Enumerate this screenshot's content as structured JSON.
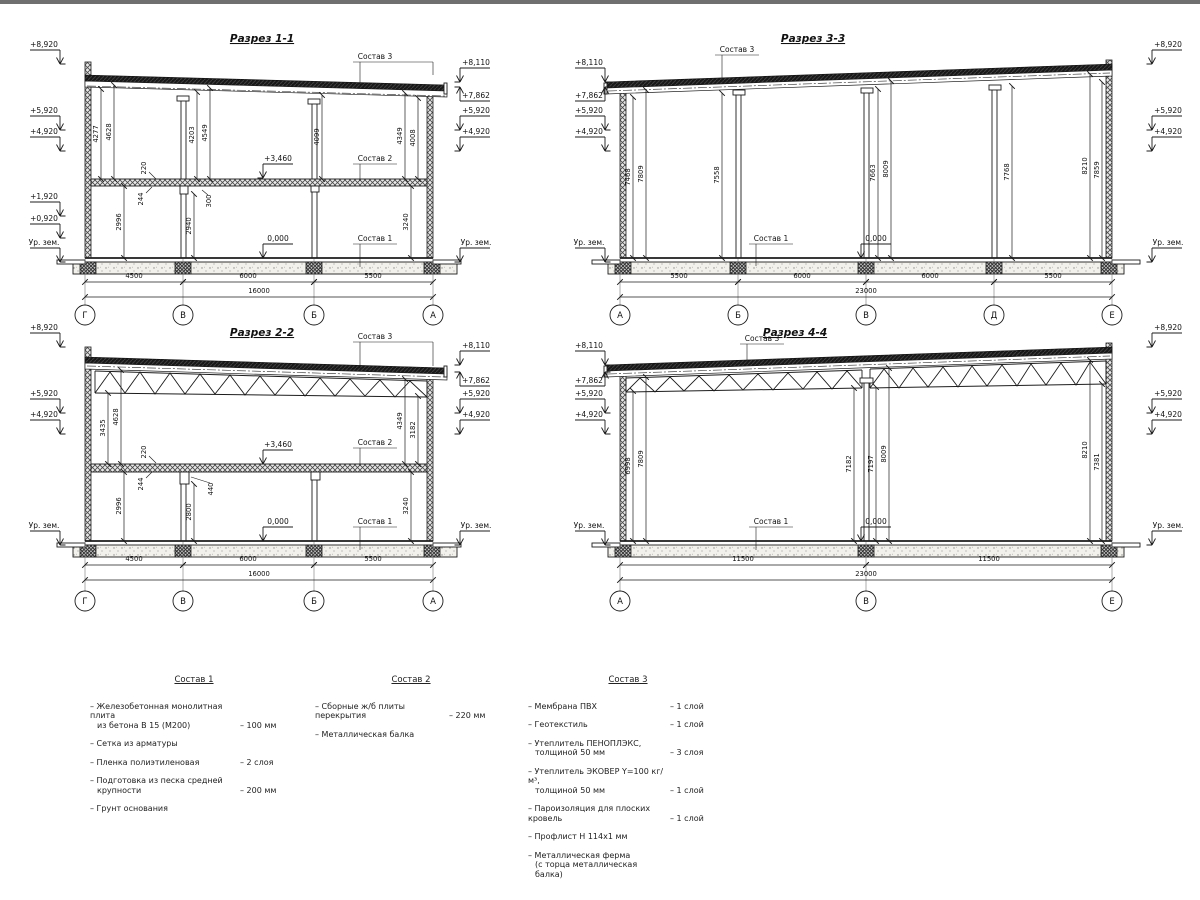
{
  "s11": {
    "title": "Разрез 1-1",
    "elev_left": [
      "+8,920",
      "+5,920",
      "+4,920",
      "+1,920",
      "+0,920",
      "Ур. зем."
    ],
    "elev_right": [
      "+8,110",
      "+7,862",
      "+5,920",
      "+4,920",
      "Ур. зем."
    ],
    "levels": [
      "+3,460",
      "0,000"
    ],
    "labels": [
      "Состав 3",
      "Состав 2",
      "Состав 1"
    ],
    "vdims": [
      "4277",
      "4628",
      "4203",
      "4549",
      "4099",
      "4349",
      "4008",
      "220",
      "244",
      "300",
      "2996",
      "2940",
      "3240"
    ],
    "bdims": [
      "4500",
      "6000",
      "5500"
    ],
    "total": "16000",
    "axes": [
      "Г",
      "В",
      "Б",
      "А"
    ]
  },
  "s22": {
    "title": "Разрез 2-2",
    "elev_left": [
      "+8,920",
      "+5,920",
      "+4,920",
      "Ур. зем."
    ],
    "elev_right": [
      "+8,110",
      "+7,862",
      "+5,920",
      "+4,920",
      "Ур. зем."
    ],
    "levels": [
      "+3,460",
      "0,000"
    ],
    "labels": [
      "Состав 3",
      "Состав 2",
      "Состав 1"
    ],
    "vdims": [
      "3435",
      "4628",
      "220",
      "244",
      "2996",
      "2800",
      "440",
      "4349",
      "3182",
      "3240"
    ],
    "bdims": [
      "4500",
      "6000",
      "5500"
    ],
    "total": "16000",
    "axes": [
      "Г",
      "В",
      "Б",
      "А"
    ]
  },
  "s33": {
    "title": "Разрез 3-3",
    "elev_left": [
      "+8,110",
      "+7,862",
      "+5,920",
      "+4,920",
      "Ур. зем."
    ],
    "elev_right": [
      "+8,920",
      "+5,920",
      "+4,920",
      "Ур. зем."
    ],
    "levels": [
      "0,000"
    ],
    "labels": [
      "Состав 3",
      "Состав 1"
    ],
    "vdims": [
      "7468",
      "7809",
      "7558",
      "7663",
      "8009",
      "7768",
      "8210",
      "7859"
    ],
    "bdims": [
      "5500",
      "6000",
      "6000",
      "5500"
    ],
    "total": "23000",
    "axes": [
      "А",
      "Б",
      "В",
      "Д",
      "Е"
    ]
  },
  "s44": {
    "title": "Разрез 4-4",
    "elev_left": [
      "+8,110",
      "+7,862",
      "+5,920",
      "+4,920",
      "Ур. зем."
    ],
    "elev_right": [
      "+8,920",
      "+5,920",
      "+4,920",
      "Ур. зем."
    ],
    "levels": [
      "0,000"
    ],
    "labels": [
      "Состав 3",
      "Состав 1"
    ],
    "vdims": [
      "6998",
      "7809",
      "7182",
      "7197",
      "8009",
      "8210",
      "7381"
    ],
    "bdims": [
      "11500",
      "11500"
    ],
    "total": "23000",
    "axes": [
      "А",
      "В",
      "Е"
    ]
  },
  "legend": {
    "c1": {
      "title": "Состав 1",
      "items": [
        {
          "l1": "– Железобетонная  монолитная плита",
          "l2": "из бетона В 15 (М200)",
          "v": "– 100 мм"
        },
        {
          "l1": "– Сетка из арматуры",
          "l2": "",
          "v": ""
        },
        {
          "l1": "– Пленка полиэтиленовая",
          "l2": "",
          "v": "–  2 слоя"
        },
        {
          "l1": "– Подготовка из песка средней",
          "l2": "крупности",
          "v": "– 200 мм"
        },
        {
          "l1": "– Грунт основания",
          "l2": "",
          "v": ""
        }
      ]
    },
    "c2": {
      "title": "Состав 2",
      "items": [
        {
          "l1": "– Сборные ж/б плиты перекрытия",
          "l2": "",
          "v": "– 220 мм"
        },
        {
          "l1": "– Металлическая балка",
          "l2": "",
          "v": ""
        }
      ]
    },
    "c3": {
      "title": "Состав 3",
      "items": [
        {
          "l1": "– Мембрана ПВХ",
          "l2": "",
          "v": "– 1 слой"
        },
        {
          "l1": "– Геотекстиль",
          "l2": "",
          "v": "– 1 слой"
        },
        {
          "l1": "– Утеплитель ПЕНОПЛЭКС,",
          "l2": "толщиной 50 мм",
          "v": "– 3 слоя"
        },
        {
          "l1": "– Утеплитель ЭКОВЕР Y=100 кг/м³,",
          "l2": "толщиной 50 мм",
          "v": "– 1 слой"
        },
        {
          "l1": "– Пароизоляция для плоских кровель",
          "l2": "",
          "v": "– 1 слой"
        },
        {
          "l1": "– Профлист Н 114х1 мм",
          "l2": "",
          "v": ""
        },
        {
          "l1": "– Металлическая ферма",
          "l2": "(с торца металлическая балка)",
          "v": ""
        }
      ]
    }
  },
  "colors": {
    "line": "#1c1c1c",
    "paper": "#ffffff"
  }
}
